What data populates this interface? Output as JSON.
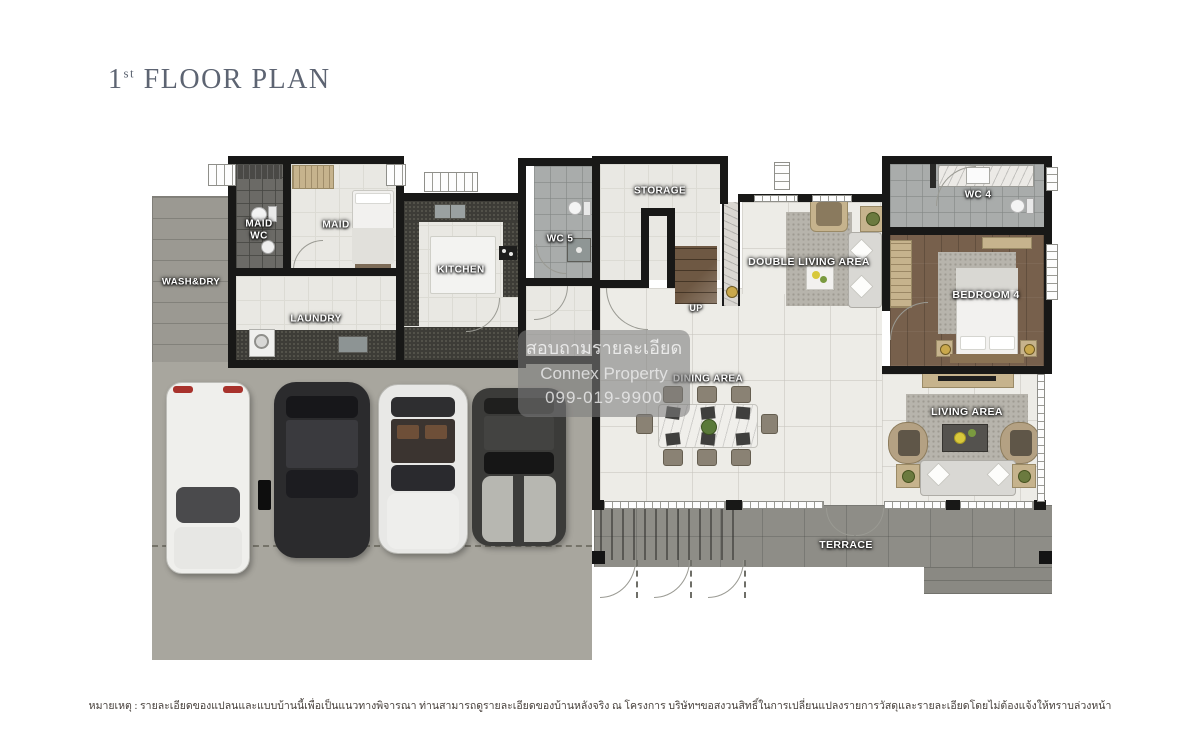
{
  "header": {
    "title_number": "1",
    "title_ordinal": "st",
    "title_text": " FLOOR PLAN"
  },
  "rooms": {
    "wash_dry": "WASH&DRY",
    "maid_wc": "MAID WC",
    "maid": "MAID",
    "laundry": "LAUNDRY",
    "kitchen": "KITCHEN",
    "wc5": "WC 5",
    "storage": "STORAGE",
    "up": "UP",
    "double_living": "DOUBLE LIVING AREA",
    "wc4": "WC 4",
    "bedroom4": "BEDROOM 4",
    "dining": "DINING AREA",
    "living": "LIVING AREA",
    "terrace": "TERRACE"
  },
  "watermark": {
    "line1": "สอบถามรายละเอียด",
    "line2": "Connex Property",
    "line3": "099-019-9900"
  },
  "footer": {
    "note": "หมายเหตุ : รายละเอียดของแปลนและแบบบ้านนี้เพื่อเป็นแนวทางพิจารณา ท่านสามารถดูรายละเอียดของบ้านหลังจริง ณ โครงการ บริษัทฯขอสงวนสิทธิ์ในการเปลี่ยนแปลงรายการวัสดุและรายละเอียดโดยไม่ต้องแจ้งให้ทราบล่วงหน้า"
  },
  "colors": {
    "title_text": "#5d6472",
    "wall": "#181817",
    "interior_tile": "#e9e8e3",
    "marble_floor": "#edece7",
    "driveway": "#a8a69e",
    "terrace": "#8e8d87",
    "wash_dry_strip": "#9b9992",
    "wood_floor": "#77604c",
    "counter_dark": "#3d3c37",
    "rug": "#b7b4ac",
    "furniture_tan": "#c6b38d",
    "watermark_bg": "#7c7c7c",
    "label_text": "#ffffff"
  }
}
